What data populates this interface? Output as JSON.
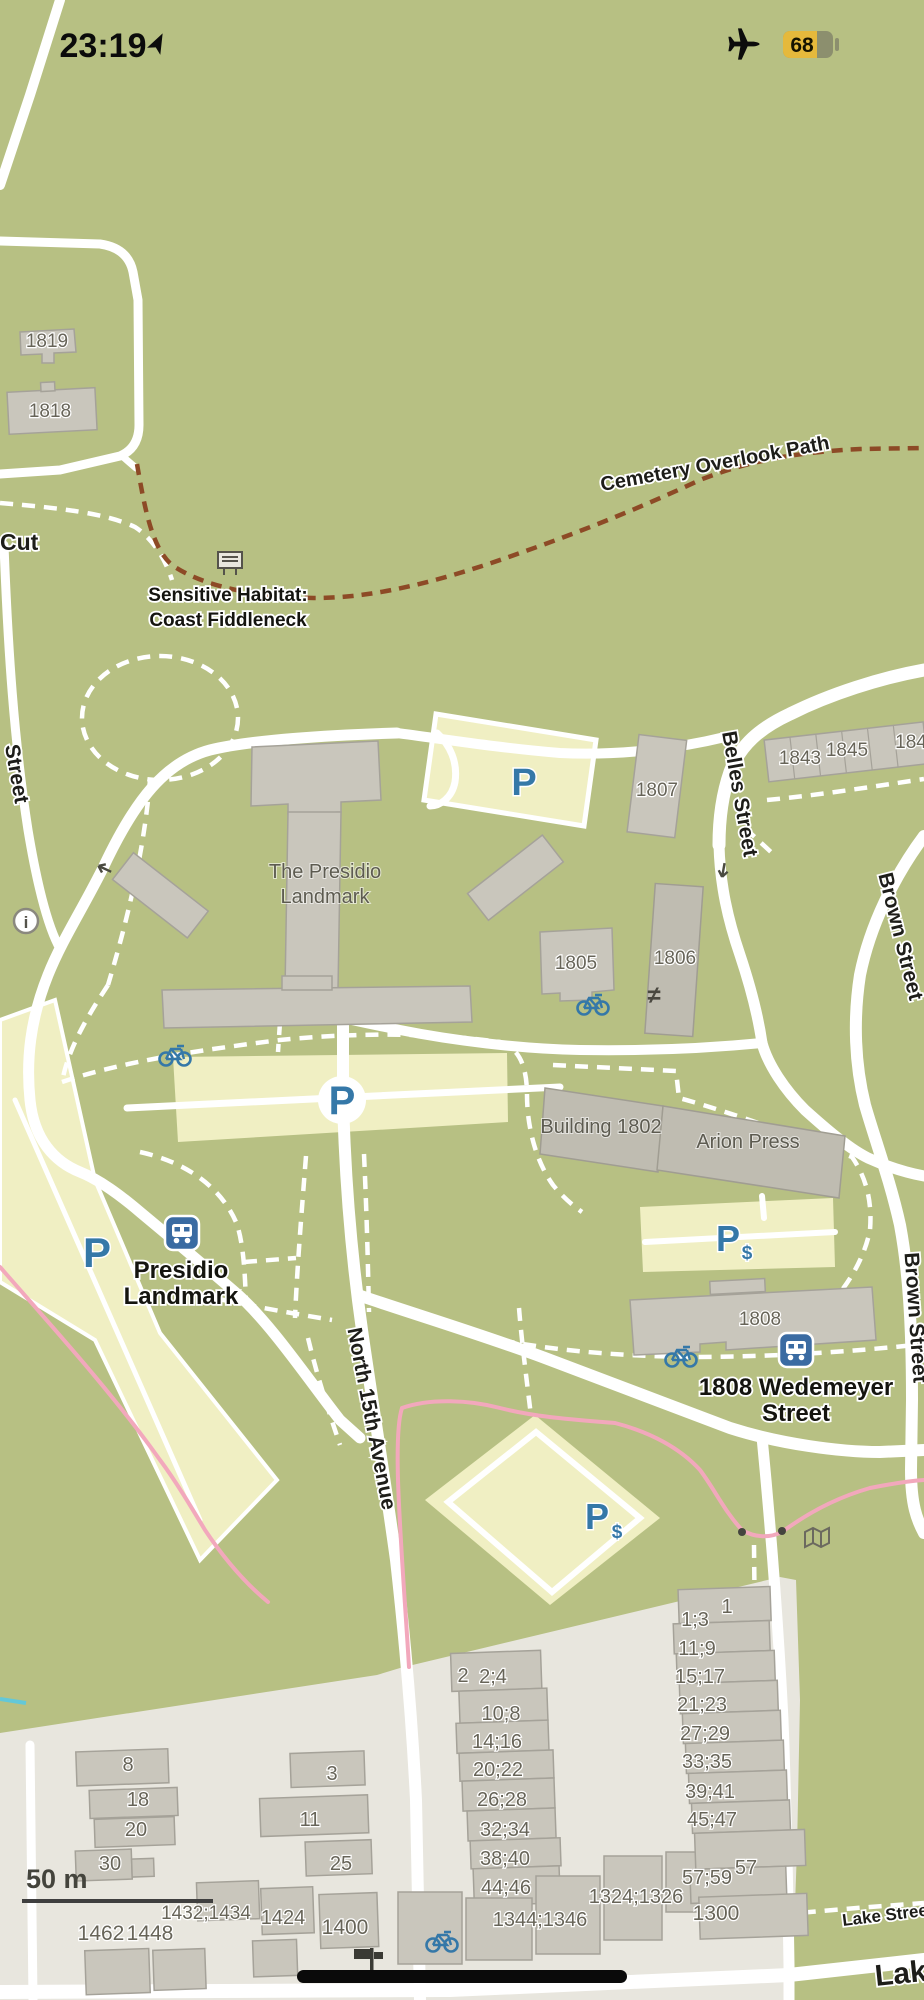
{
  "status_bar": {
    "time": "23:19",
    "battery": "68"
  },
  "streets": {
    "cut": "Cut",
    "left_partial": "Street",
    "cemetery": "Cemetery Overlook Path",
    "belles": "Belles Street",
    "brown_upper": "Brown Street",
    "brown_lower": "Brown Street",
    "north_15th": "North 15th Avenue",
    "lake_small": "Lake Street",
    "lake_large": "Lake"
  },
  "pois": {
    "habitat_line1": "Sensitive Habitat:",
    "habitat_line2": "Coast Fiddleneck",
    "landmark_name_line1": "The Presidio",
    "landmark_name_line2": "Landmark",
    "bus_presidio_line1": "Presidio",
    "bus_presidio_line2": "Landmark",
    "bus_wedemeyer_line1": "1808 Wedemeyer",
    "bus_wedemeyer_line2": "Street",
    "building_1802": "Building 1802",
    "arion_press": "Arion Press",
    "parking_letter": "P",
    "paid_suffix": "$",
    "gate_symbol": "≠"
  },
  "buildings": {
    "b1819": "1819",
    "b1818": "1818",
    "b1807": "1807",
    "b1843": "1843",
    "b1845": "1845",
    "b184x": "184",
    "b1805": "1805",
    "b1806": "1806",
    "b1808": "1808",
    "n8": "8",
    "n18": "18",
    "n20": "20",
    "n30": "30",
    "n3": "3",
    "n11": "11",
    "n25": "25",
    "n1462": "1462",
    "n1448": "1448",
    "n1432_1434": "1432;1434",
    "n1424": "1424",
    "n1400": "1400",
    "n2": "2",
    "n2_4": "2;4",
    "n10_8": "10;8",
    "n14_16": "14;16",
    "n20_22": "20;22",
    "n26_28": "26;28",
    "n32_34": "32;34",
    "n38_40": "38;40",
    "n44_46": "44;46",
    "n1344_1346": "1344;1346",
    "n1324_1326": "1324;1326",
    "n1": "1",
    "n1_3": "1;3",
    "n11_9": "11;9",
    "n15_17": "15;17",
    "n21_23": "21;23",
    "n27_29": "27;29",
    "n33_35": "33;35",
    "n39_41": "39;41",
    "n45_47": "45;47",
    "n57_59": "57;59",
    "n57": "57",
    "n1300": "1300"
  },
  "scale_bar": {
    "label": "50 m"
  },
  "colors": {
    "map_green": "#b7c083",
    "urban_gray": "#e8e6de",
    "building_fill": "#c9c6bc",
    "parking_fill": "#f0efc3",
    "road_white": "#ffffff",
    "trail_brown": "#8d4a26",
    "route_pink": "#f2a8bc",
    "water_cyan": "#63c8d8",
    "poi_blue": "#3578a8",
    "bus_blue": "#3a6ba2",
    "battery_yellow": "#e5b93c"
  }
}
